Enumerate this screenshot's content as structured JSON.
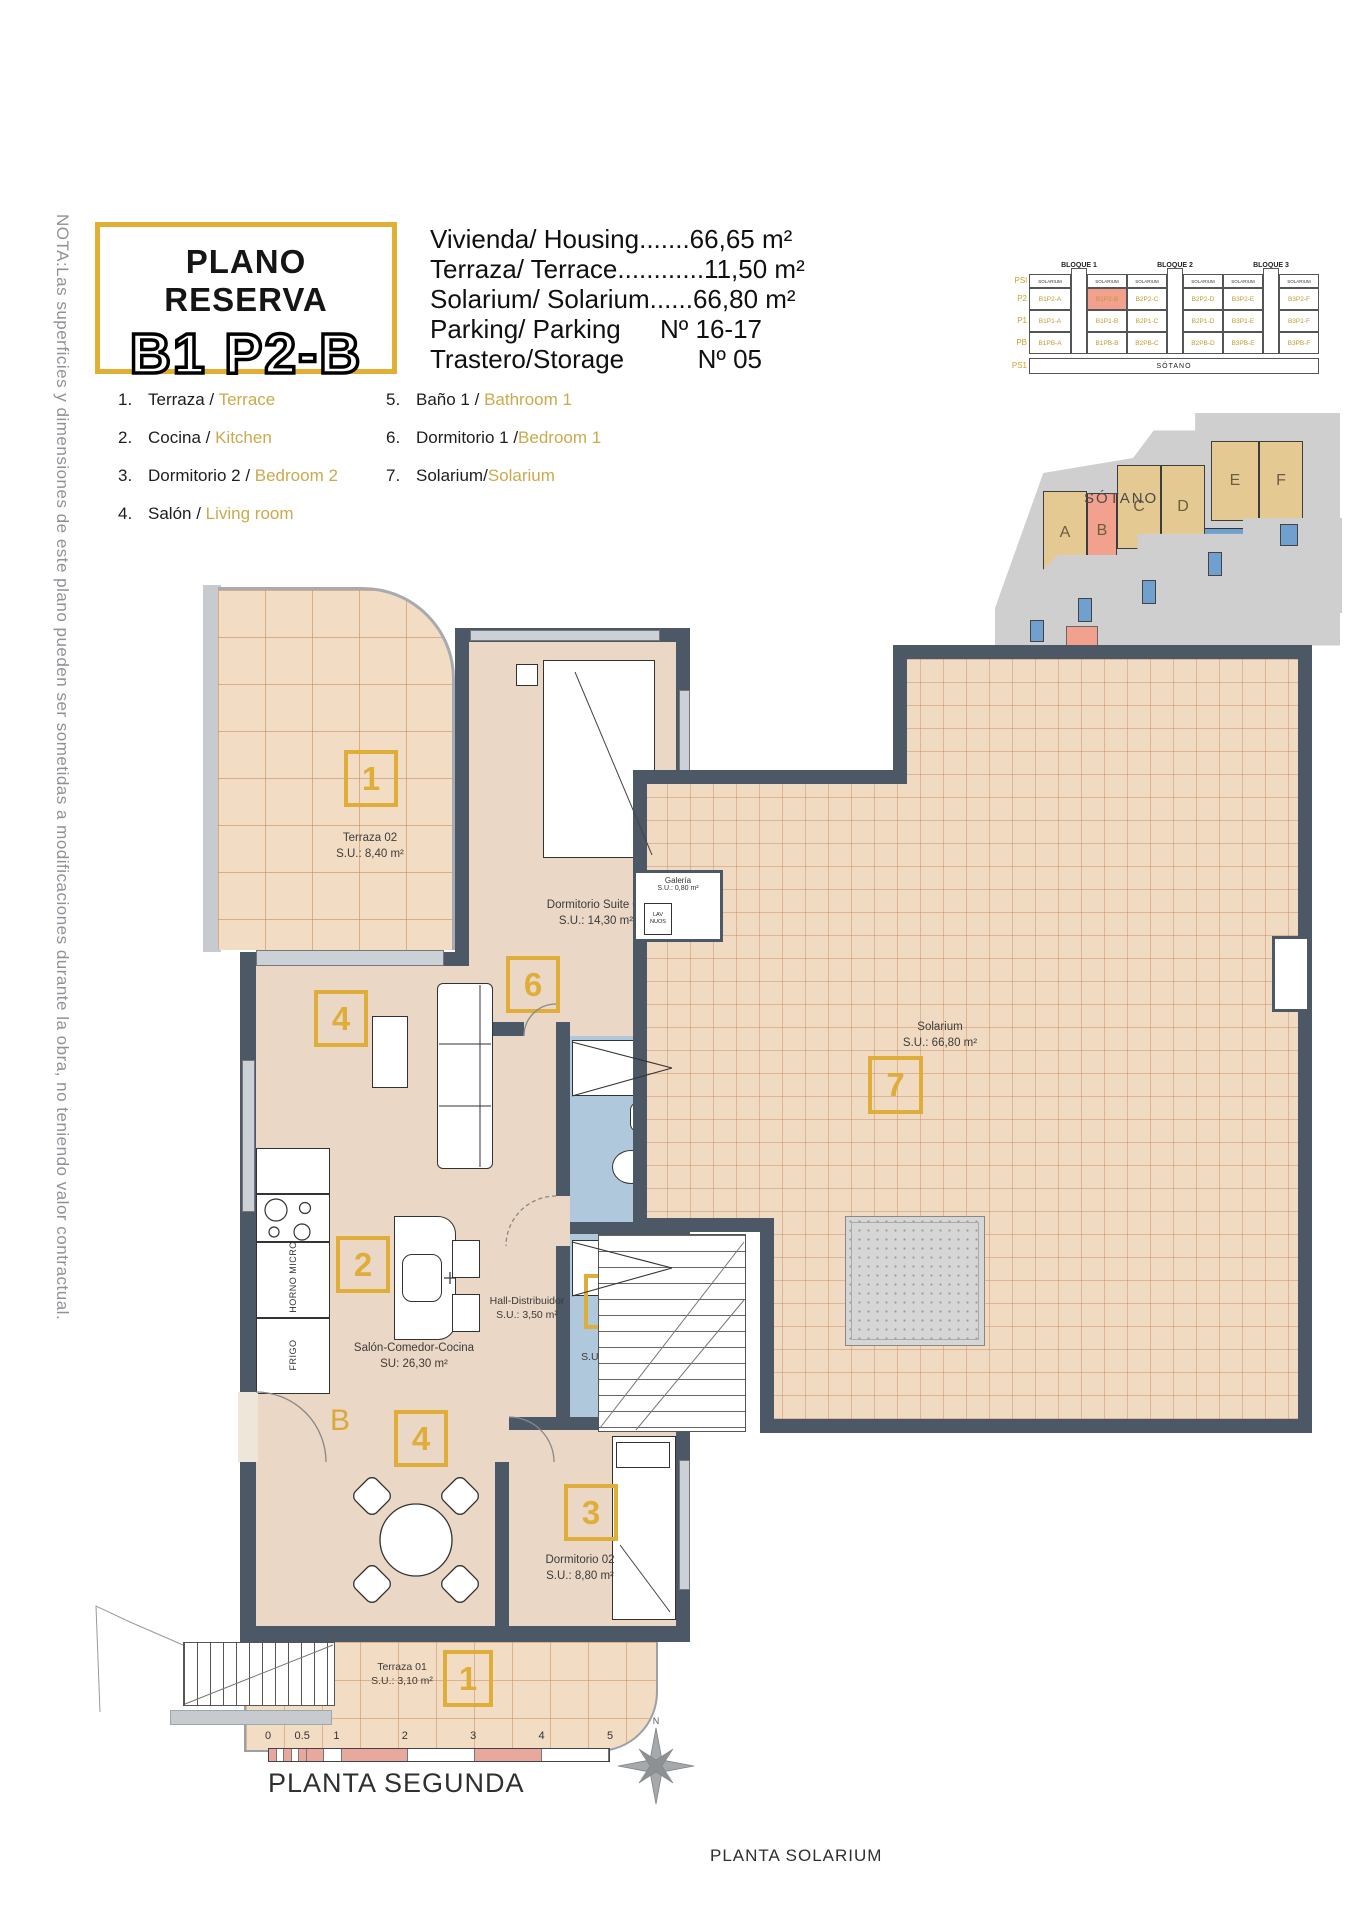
{
  "note": "NOTA:Las superficies y dimensiones de este plano pueden ser sometidas a modificaciones durante la obra, no teniendo valor contractual.",
  "title": {
    "line1": "PLANO RESERVA",
    "line2": "B1 P2-B"
  },
  "summary": {
    "lines": [
      "Vivienda/ Housing.......66,65 m²",
      "Terraza/ Terrace............11,50 m²",
      "Solarium/ Solarium......66,80 m²"
    ],
    "parking_label": "Parking/ Parking",
    "parking_value": "Nº 16-17",
    "storage_label": "Trastero/Storage",
    "storage_value": "Nº 05"
  },
  "legend": {
    "items": [
      {
        "num": "1.",
        "es": "Terraza",
        "sep": " / ",
        "en": "Terrace"
      },
      {
        "num": "2.",
        "es": "Cocina",
        "sep": " / ",
        "en": "Kitchen"
      },
      {
        "num": "3.",
        "es": "Dormitorio 2",
        "sep": " / ",
        "en": "Bedroom 2"
      },
      {
        "num": "4.",
        "es": "Salón",
        "sep": " / ",
        "en": "Living room"
      },
      {
        "num": "5.",
        "es": "Baño 1",
        "sep": " / ",
        "en": "Bathroom 1"
      },
      {
        "num": "6.",
        "es": "Dormitorio 1",
        "sep": " /",
        "en": "Bedroom 1"
      },
      {
        "num": "7.",
        "es": "Solarium",
        "sep": "/",
        "en": "Solarium"
      }
    ]
  },
  "matrix": {
    "bloques": [
      "BLOQUE 1",
      "BLOQUE 2",
      "BLOQUE 3"
    ],
    "row_labels": [
      "PSl",
      "P2",
      "P1",
      "PB",
      "PS1"
    ],
    "solarium_cell": "SOLARIUM",
    "cells": {
      "P2": [
        "B1P2-A",
        "B1P2-B",
        "B2P2-C",
        "B2P2-D",
        "B3P2-E",
        "B3P2-F"
      ],
      "P1": [
        "B1P1-A",
        "B1P1-B",
        "B2P1-C",
        "B2P1-D",
        "B3P1-E",
        "B3P1-F"
      ],
      "PB": [
        "B1PB-A",
        "B1PB-B",
        "B2PB-C",
        "B2PB-D",
        "B3PB-E",
        "B3PB-F"
      ]
    },
    "highlight": "B1P2-B",
    "sotano": "SÓTANO"
  },
  "site": {
    "units": [
      "A",
      "B",
      "C",
      "D",
      "E",
      "F"
    ],
    "sotano_label": "SÓTANO"
  },
  "plan": {
    "terraza02": {
      "name": "Terraza 02",
      "area": "S.U.: 8,40 m²",
      "marker": "1"
    },
    "suite": {
      "name": "Dormitorio Suite 01",
      "area": "S.U.: 14,30 m²",
      "marker": "6"
    },
    "living": {
      "marker": "4"
    },
    "kitchen": {
      "marker": "2",
      "horno": "HORNO MICRO",
      "frigo": "FRIGO"
    },
    "salon": {
      "name": "Salón-Comedor-Cocina",
      "area": "SU: 26,30 m²"
    },
    "hall": {
      "name": "Hall-Distribuidor",
      "area": "S.U.: 3,50 m²"
    },
    "bano": {
      "name": "Baño",
      "area": "S.U.: 3,40 m²",
      "marker": "5"
    },
    "dining": {
      "marker": "4"
    },
    "dorm02": {
      "name": "Dormitorio 02",
      "area": "S.U.: 8,80 m²",
      "marker": "3"
    },
    "terraza01": {
      "name": "Terraza 01",
      "area": "S.U.: 3,10 m²",
      "marker": "1"
    },
    "solarium": {
      "name": "Solarium",
      "area": "S.U.: 66,80 m²",
      "marker": "7"
    },
    "galeria": {
      "name": "Galería",
      "area": "S.U.: 0,80 m²",
      "appliance1": "LAV",
      "appliance2": "NUOS"
    },
    "door": "B"
  },
  "scale": {
    "ticks": [
      "0",
      "0.5",
      "1",
      "2",
      "3",
      "4",
      "5"
    ]
  },
  "captions": {
    "plan_left": "PLANTA SEGUNDA",
    "plan_right": "PLANTA SOLARIUM"
  },
  "compass": {
    "n": "N"
  },
  "colors": {
    "accent_gold": "#DFAE3A",
    "wall": "#4C5866",
    "bath_blue": "#AFC8DC",
    "highlight_salmon": "#F2A18E",
    "site_tan": "#E5C992",
    "pool_blue": "#6FA0CE",
    "scale_salmon": "#E9A89E"
  }
}
